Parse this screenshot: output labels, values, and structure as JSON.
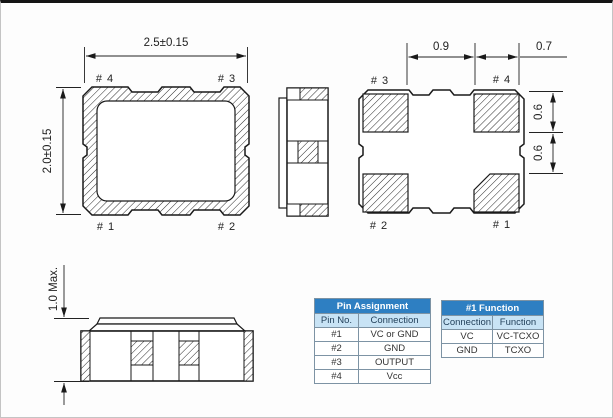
{
  "colors": {
    "table_header_bg": "#2e7fc2",
    "table_header_text": "#ffffff",
    "table_subheader_bg": "#c8e3f5",
    "table_border": "#7d93a4",
    "line": "#1a1a1a"
  },
  "drawing": {
    "top_view": {
      "dim_width": "2.5±0.15",
      "dim_height": "2.0±0.15",
      "pin_tl": "# 4",
      "pin_tr": "# 3",
      "pin_bl": "# 1",
      "pin_br": "# 2"
    },
    "bottom_view": {
      "dim_pad_pitch": "0.9",
      "dim_pad_width": "0.7",
      "dim_pad_height": "0.6",
      "dim_pad_gap": "0.6",
      "pin_tl": "# 3",
      "pin_tr": "# 4",
      "pin_bl": "# 2",
      "pin_br": "# 1"
    },
    "front_view": {
      "dim_height": "1.0 Max."
    }
  },
  "tables": {
    "pin_assignment": {
      "title": "Pin Assignment",
      "columns": [
        "Pin No.",
        "Connection"
      ],
      "rows": [
        [
          "#1",
          "VC or GND"
        ],
        [
          "#2",
          "GND"
        ],
        [
          "#3",
          "OUTPUT"
        ],
        [
          "#4",
          "Vcc"
        ]
      ]
    },
    "pin1_function": {
      "title": "#1 Function",
      "columns": [
        "Connection",
        "Function"
      ],
      "rows": [
        [
          "VC",
          "VC-TCXO"
        ],
        [
          "GND",
          "TCXO"
        ]
      ]
    }
  }
}
